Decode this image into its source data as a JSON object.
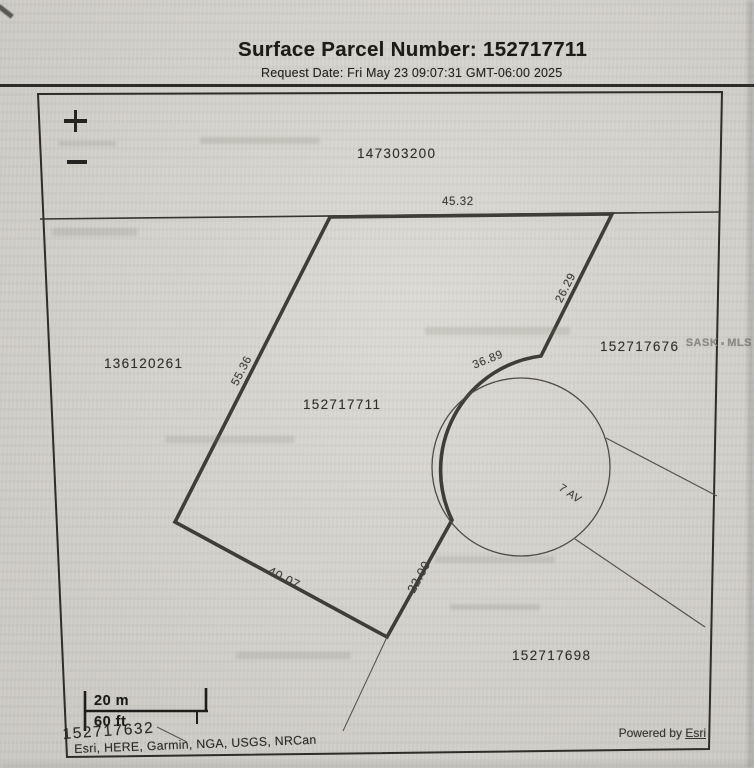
{
  "palette": {
    "paper": "#d8d6cf",
    "ink": "#232320",
    "boundary_thick": "#3f3d37",
    "boundary_thin": "#55534c",
    "watermark_gray": "#8d8d87"
  },
  "header": {
    "title": "Surface Parcel Number: 152717711",
    "request_date": "Request Date: Fri May 23 09:07:31 GMT-06:00 2025"
  },
  "map": {
    "controls": {
      "zoom_in_icon": "plus",
      "zoom_out_icon": "minus"
    },
    "labels": {
      "parcel_top": "147303200",
      "parcel_left": "136120261",
      "parcel_center": "152717711",
      "parcel_right": "152717676",
      "parcel_bottom_right": "152717698",
      "parcel_bottom_left": "152717632",
      "dim_top": "45.32",
      "dim_northeast": "26.29",
      "dim_arc": "36.89",
      "dim_west": "55.36",
      "dim_southwest": "40.07",
      "dim_southeast": "22.00",
      "street": "7 AV"
    },
    "scale_bar": {
      "metric": "20 m",
      "imperial": "60 ft"
    }
  },
  "footer": {
    "attribution": "Esri, HERE, Garmin, NGA, USGS, NRCan",
    "powered_by_prefix": "Powered by",
    "powered_by_link": "Esri"
  },
  "watermark": {
    "left": "SASK",
    "right": "MLS"
  }
}
